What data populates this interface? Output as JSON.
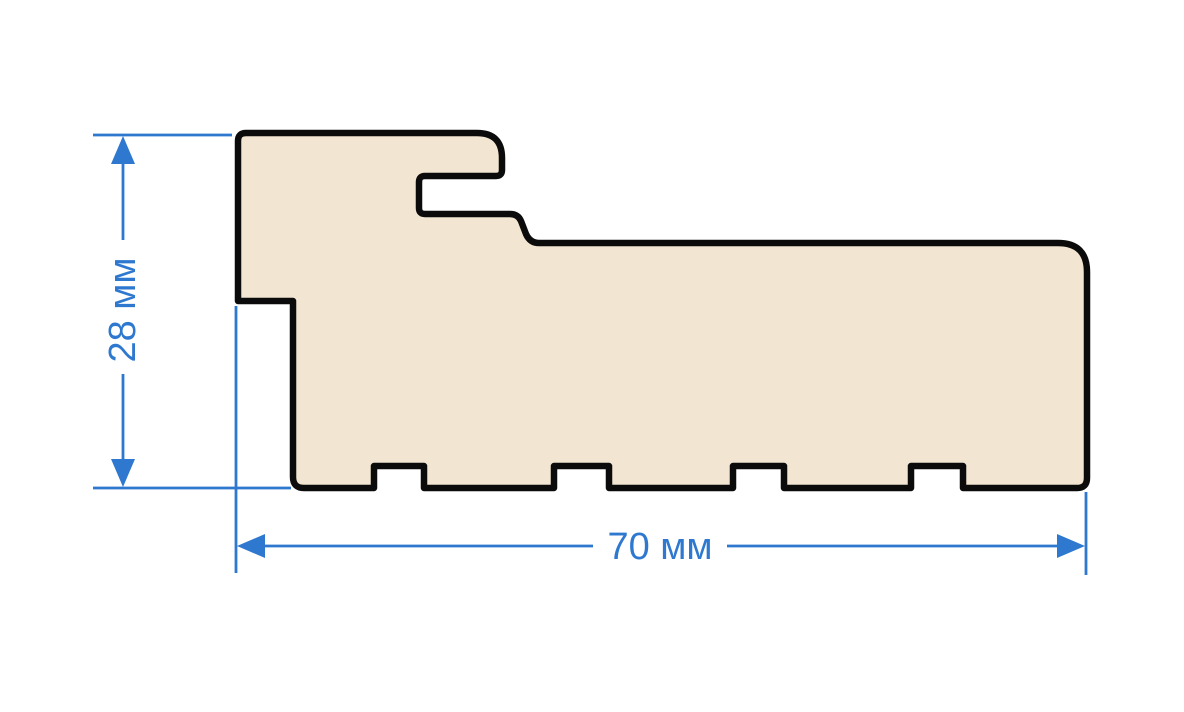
{
  "diagram": {
    "type": "profile-cross-section",
    "dimensions": {
      "height": {
        "label": "28 мм",
        "value": 28,
        "unit": "мм"
      },
      "width": {
        "label": "70 мм",
        "value": 70,
        "unit": "мм"
      }
    },
    "colors": {
      "profile_fill": "#f2e5d2",
      "profile_outline": "#0b0b0b",
      "dimension_blue": "#2e79cf",
      "background": "#ffffff"
    }
  }
}
